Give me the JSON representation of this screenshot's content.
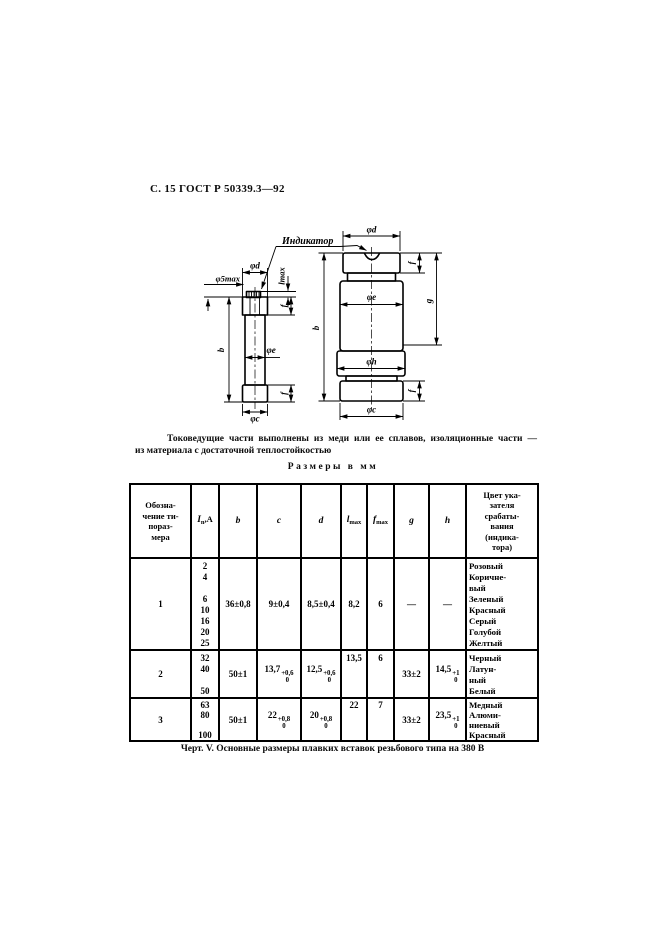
{
  "page": {
    "header": "С. 15 ГОСТ Р 50339.3—92",
    "note": {
      "line1": "Токоведущие части выполнены из меди или ее сплавов, изоляционные части —",
      "line2": "из материала с достаточной теплостойкостью"
    },
    "sizes_heading": "Размеры в мм",
    "caption": "Черт. V. Основные размеры плавких вставок резьбового типа на 380 В"
  },
  "figure": {
    "indicator_label": "Индикатор",
    "dims": {
      "phi5max": "φ5max",
      "phid": "φd",
      "lmax": "lmax",
      "b": "b",
      "f": "f",
      "phie": "φe",
      "phic": "φc",
      "g": "g",
      "phih": "φh"
    }
  },
  "table": {
    "header": {
      "col_mark_lines": [
        "Обозна-",
        "чение ти-",
        "пораз-",
        "мера"
      ],
      "col_current": {
        "base": "I",
        "sub": "n",
        "rest": ",А"
      },
      "col_b": "b",
      "col_c": "c",
      "col_d": "d",
      "col_lmax": {
        "base": "l",
        "sub": "max"
      },
      "col_fmax": {
        "base": "f",
        "sub": "max"
      },
      "col_g": "g",
      "col_h": "h",
      "col_color_lines": [
        "Цвет ука-",
        "зателя",
        "срабаты-",
        "вания",
        "(индика-",
        "тора)"
      ]
    },
    "rows": [
      {
        "mark": "1",
        "currents": [
          "2",
          "4",
          "",
          "6",
          "10",
          "16",
          "20",
          "25"
        ],
        "b": {
          "base": "36±0,8"
        },
        "c": {
          "base": "9±0,4"
        },
        "d": {
          "base": "8,5±0,4"
        },
        "lmax": "8,2",
        "fmax": "6",
        "g": {
          "base": "—"
        },
        "h": {
          "base": "—"
        },
        "colors": [
          "Розовый",
          "Коричне-",
          "вый",
          "Зеленый",
          "Красный",
          "Серый",
          "Голубой",
          "Желтый"
        ]
      },
      {
        "mark": "2",
        "currents": [
          "32",
          "40",
          "",
          "50"
        ],
        "b": {
          "base": "50±1"
        },
        "c": {
          "base": "13,7",
          "sup": "+0,6",
          "sub": "0"
        },
        "d": {
          "base": "12,5",
          "sup": "+0,6",
          "sub": "0"
        },
        "lmax": "13,5",
        "fmax": "6",
        "g": {
          "base": "33±2"
        },
        "h": {
          "base": "14,5",
          "sup": "+1",
          "sub": "0"
        },
        "colors": [
          "Черный",
          "Латун-",
          "ный",
          "Белый"
        ]
      },
      {
        "mark": "3",
        "currents": [
          "63",
          "80",
          "",
          "100"
        ],
        "b": {
          "base": "50±1"
        },
        "c": {
          "base": "22",
          "sup": "+0,8",
          "sub": "0"
        },
        "d": {
          "base": "20",
          "sup": "+0,8",
          "sub": "0"
        },
        "lmax": "22",
        "fmax": "7",
        "g": {
          "base": "33±2"
        },
        "h": {
          "base": "23,5",
          "sup": "+1",
          "sub": "0"
        },
        "colors": [
          "Медный",
          "Алюми-",
          "ниевый",
          "Красный"
        ]
      }
    ]
  }
}
